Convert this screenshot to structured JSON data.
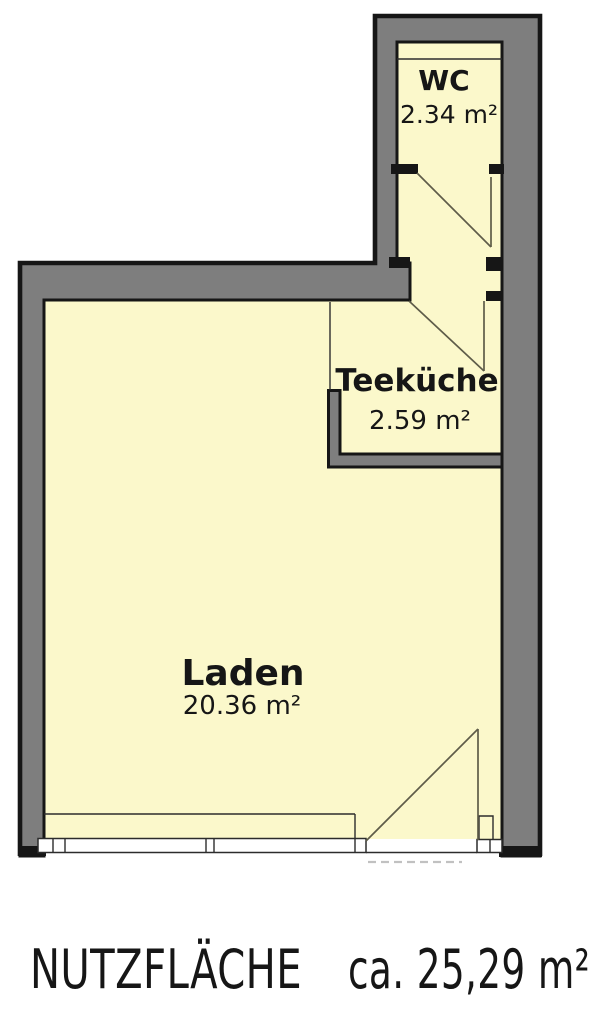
{
  "rooms": [
    {
      "id": "wc",
      "name": "WC",
      "area": "2.34 m²"
    },
    {
      "id": "teekueche",
      "name": "Teeküche",
      "area": "2.59 m²"
    },
    {
      "id": "laden",
      "name": "Laden",
      "area": "20.36 m²"
    }
  ],
  "footer": {
    "label": "NUTZFLÄCHE",
    "value": "ca. 25,29 m²"
  },
  "colors": {
    "wall": "#7e7e7e",
    "floor": "#fbf8cb",
    "ink": "#161616",
    "door-line": "#5e5c49",
    "dash": "#c1c1c1",
    "paper": "#ffffff"
  }
}
